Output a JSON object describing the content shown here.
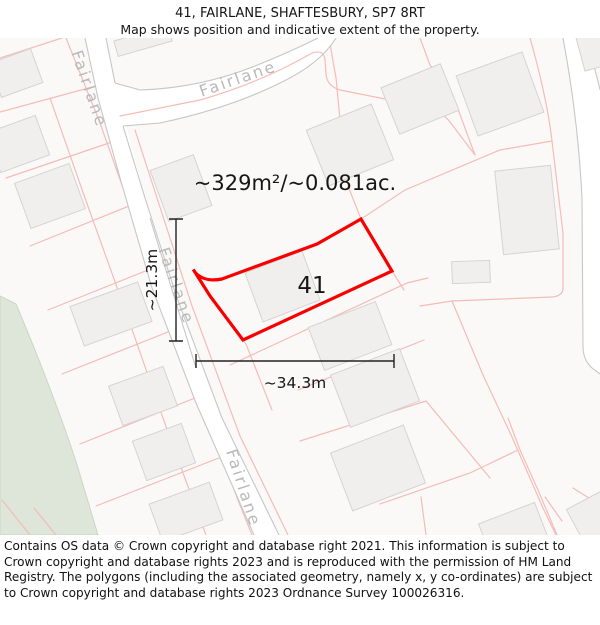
{
  "header": {
    "title": "41, FAIRLANE, SHAFTESBURY, SP7 8RT",
    "subtitle": "Map shows position and indicative extent of the property."
  },
  "map": {
    "street_name": "Fairlane",
    "plot_number": "41",
    "area_label": "~329m²/~0.081ac.",
    "dimensions": {
      "width_label": "~34.3m",
      "height_label": "~21.3m"
    },
    "colors": {
      "background": "#faf9f8",
      "parcel_line": "#f5bcb6",
      "road_edge": "#c7c7c7",
      "road_label": "#b9b9b9",
      "building_fill": "#f0efed",
      "building_stroke": "#d6d4d2",
      "green_area": "#dde6d8",
      "highlight_red": "#f80000"
    }
  },
  "footer": {
    "copyright": "Contains OS data © Crown copyright and database right 2021. This information is subject to Crown copyright and database rights 2023 and is reproduced with the permission of HM Land Registry. The polygons (including the associated geometry, namely x, y co-ordinates) are subject to Crown copyright and database rights 2023 Ordnance Survey 100026316."
  }
}
